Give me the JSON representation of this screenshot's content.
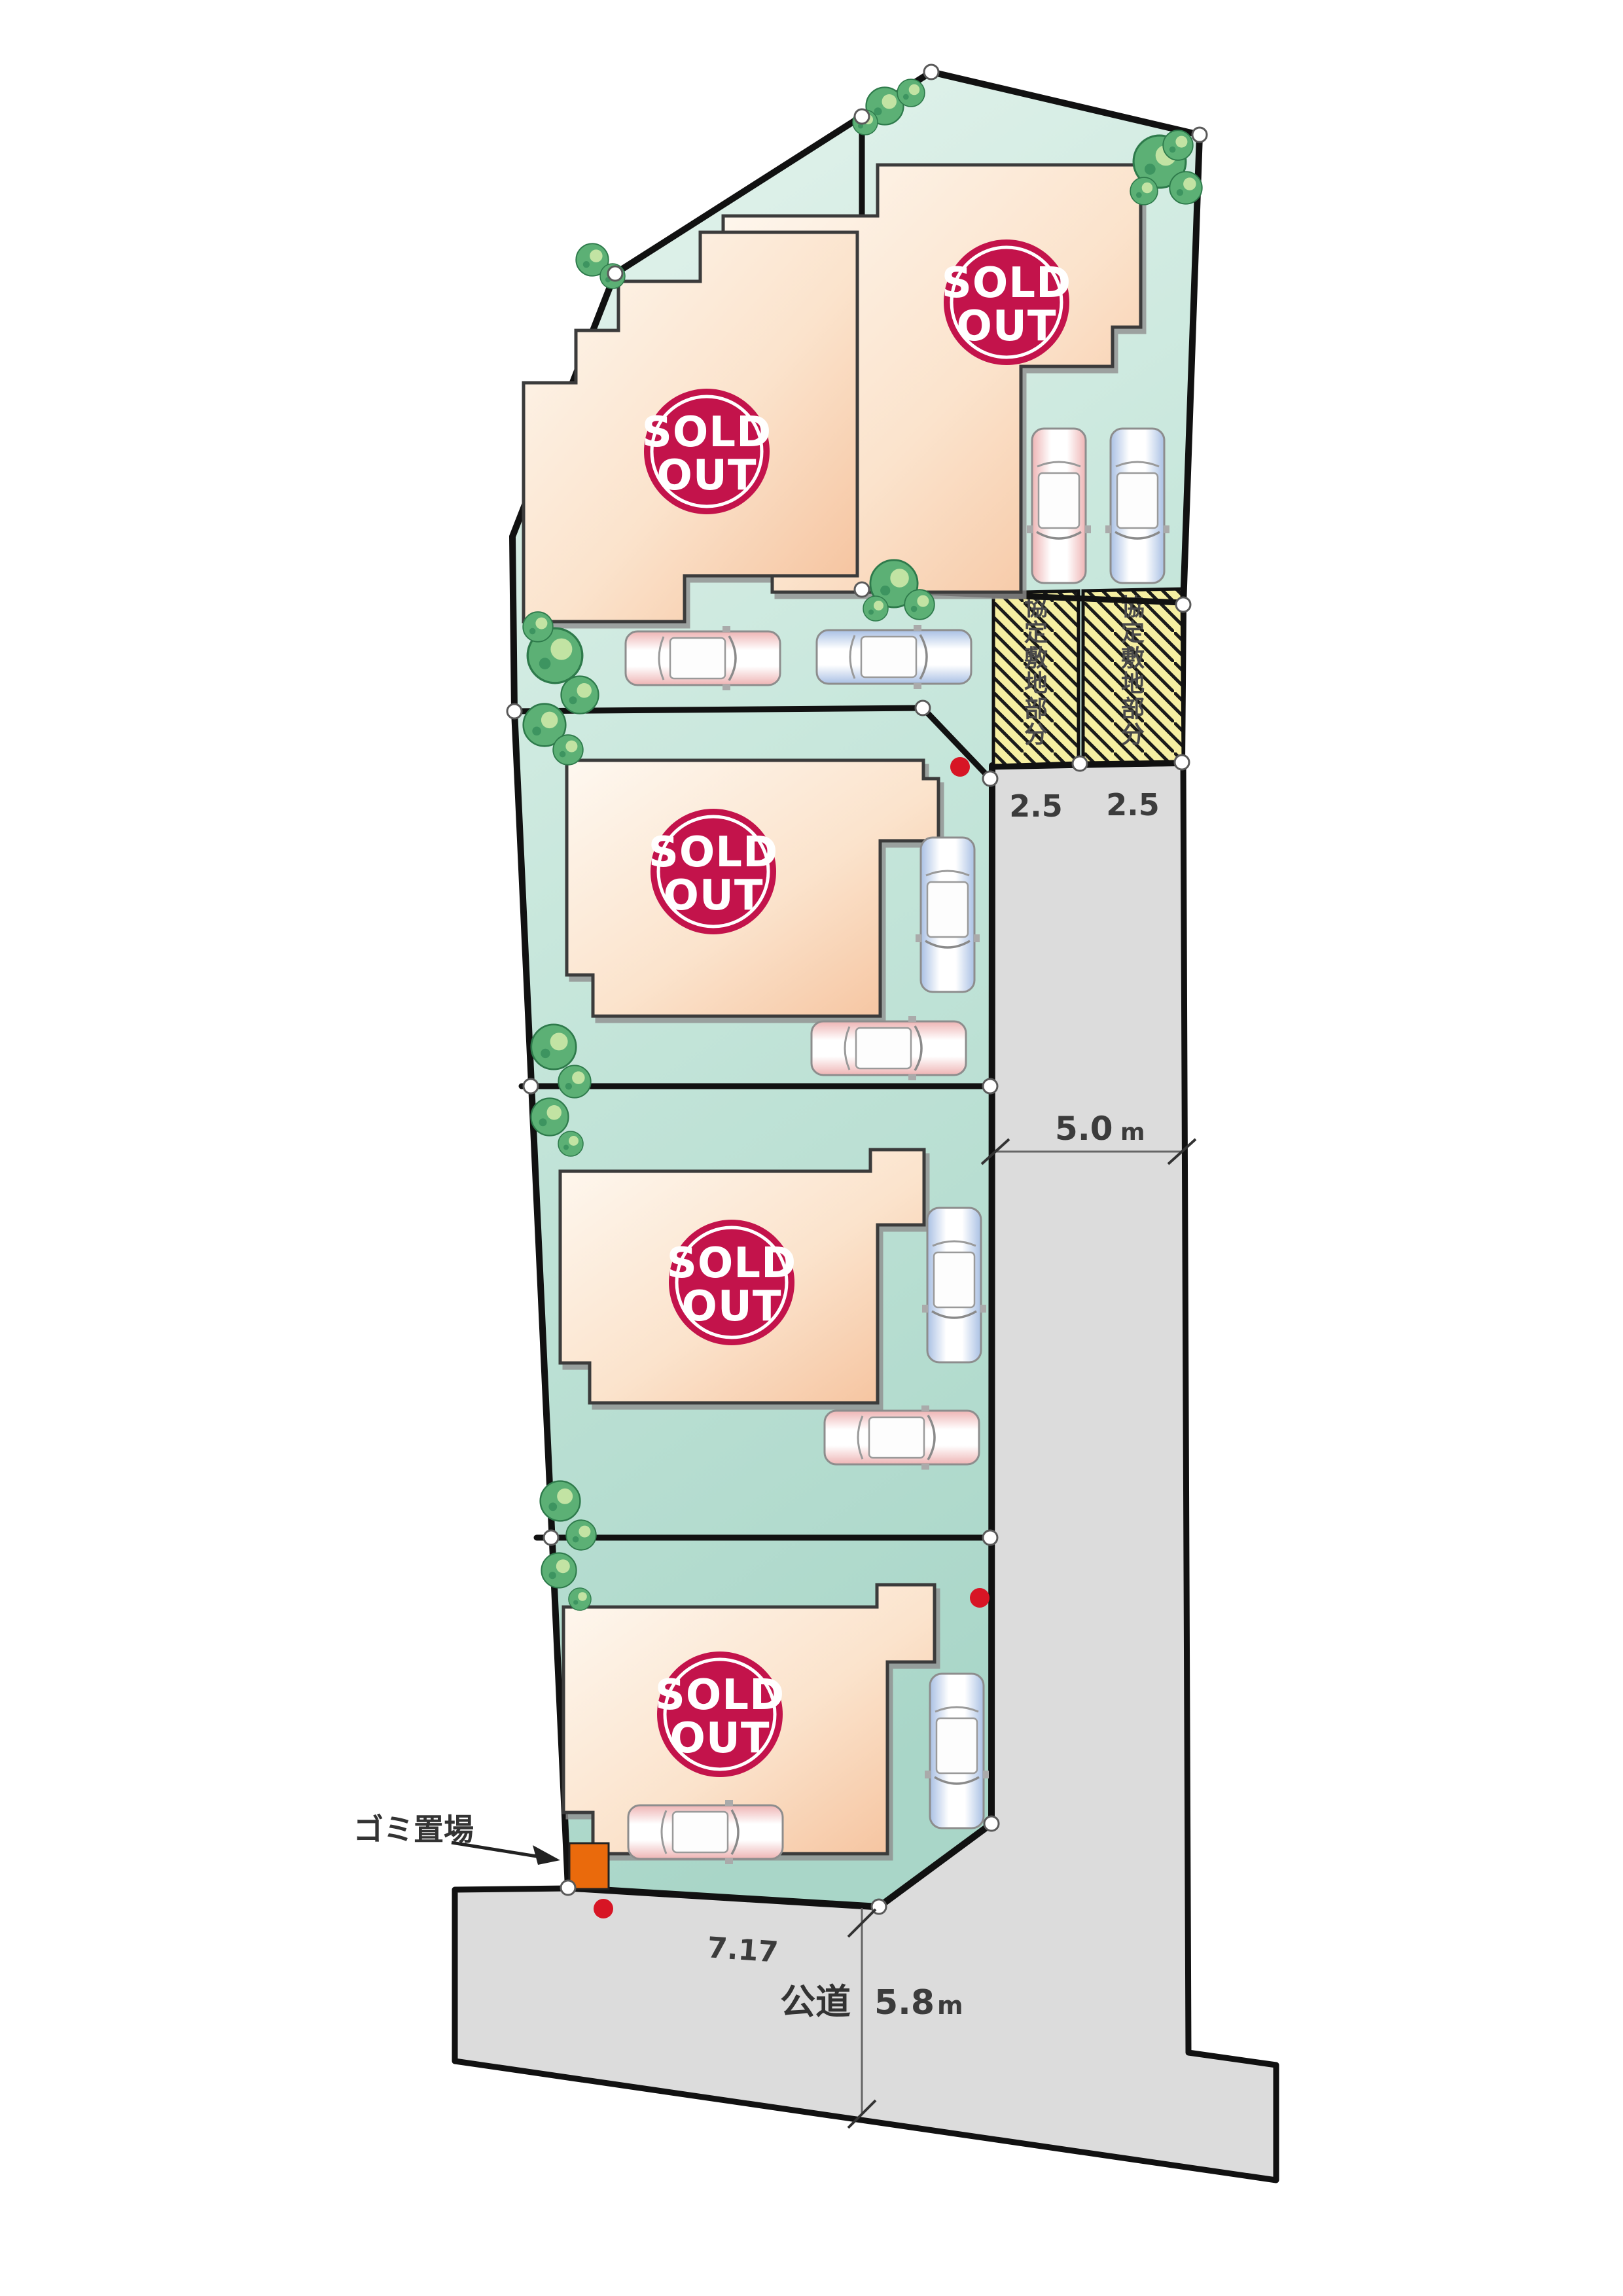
{
  "map": {
    "type": "residential-lot-plan",
    "plots": [
      {
        "id": 1,
        "status": "SOLD OUT"
      },
      {
        "id": 2,
        "status": "SOLD OUT"
      },
      {
        "id": 3,
        "status": "SOLD OUT"
      },
      {
        "id": 4,
        "status": "SOLD OUT"
      },
      {
        "id": 5,
        "status": "SOLD OUT"
      }
    ]
  },
  "labels": {
    "sold_out_top": "SOLD",
    "sold_out_bottom": "OUT",
    "agreement_area_vertical": "協定敷地部分",
    "garbage_area": "ゴミ置場",
    "public_road": "公道",
    "frontage_dim": "7.17",
    "side_road_width": "5.0",
    "side_road_unit": "m",
    "bottom_road_width": "5.8",
    "bottom_road_unit": "m",
    "agreement_width_left": "2.5",
    "agreement_width_right": "2.5"
  },
  "colors": {
    "site_teal_light": "#e3f2ec",
    "site_teal_deep": "#abd7c9",
    "road_gray": "#dcdcdc",
    "house_light": "#fdf4e9",
    "house_salmon": "#f6c29e",
    "badge_red": "#c3134b",
    "agreement_yellow": "#f6efa2",
    "tree_green": "#5cb075",
    "garbage_orange": "#ea6a0c",
    "marker_red": "#d71525",
    "outline_black": "#111111"
  }
}
